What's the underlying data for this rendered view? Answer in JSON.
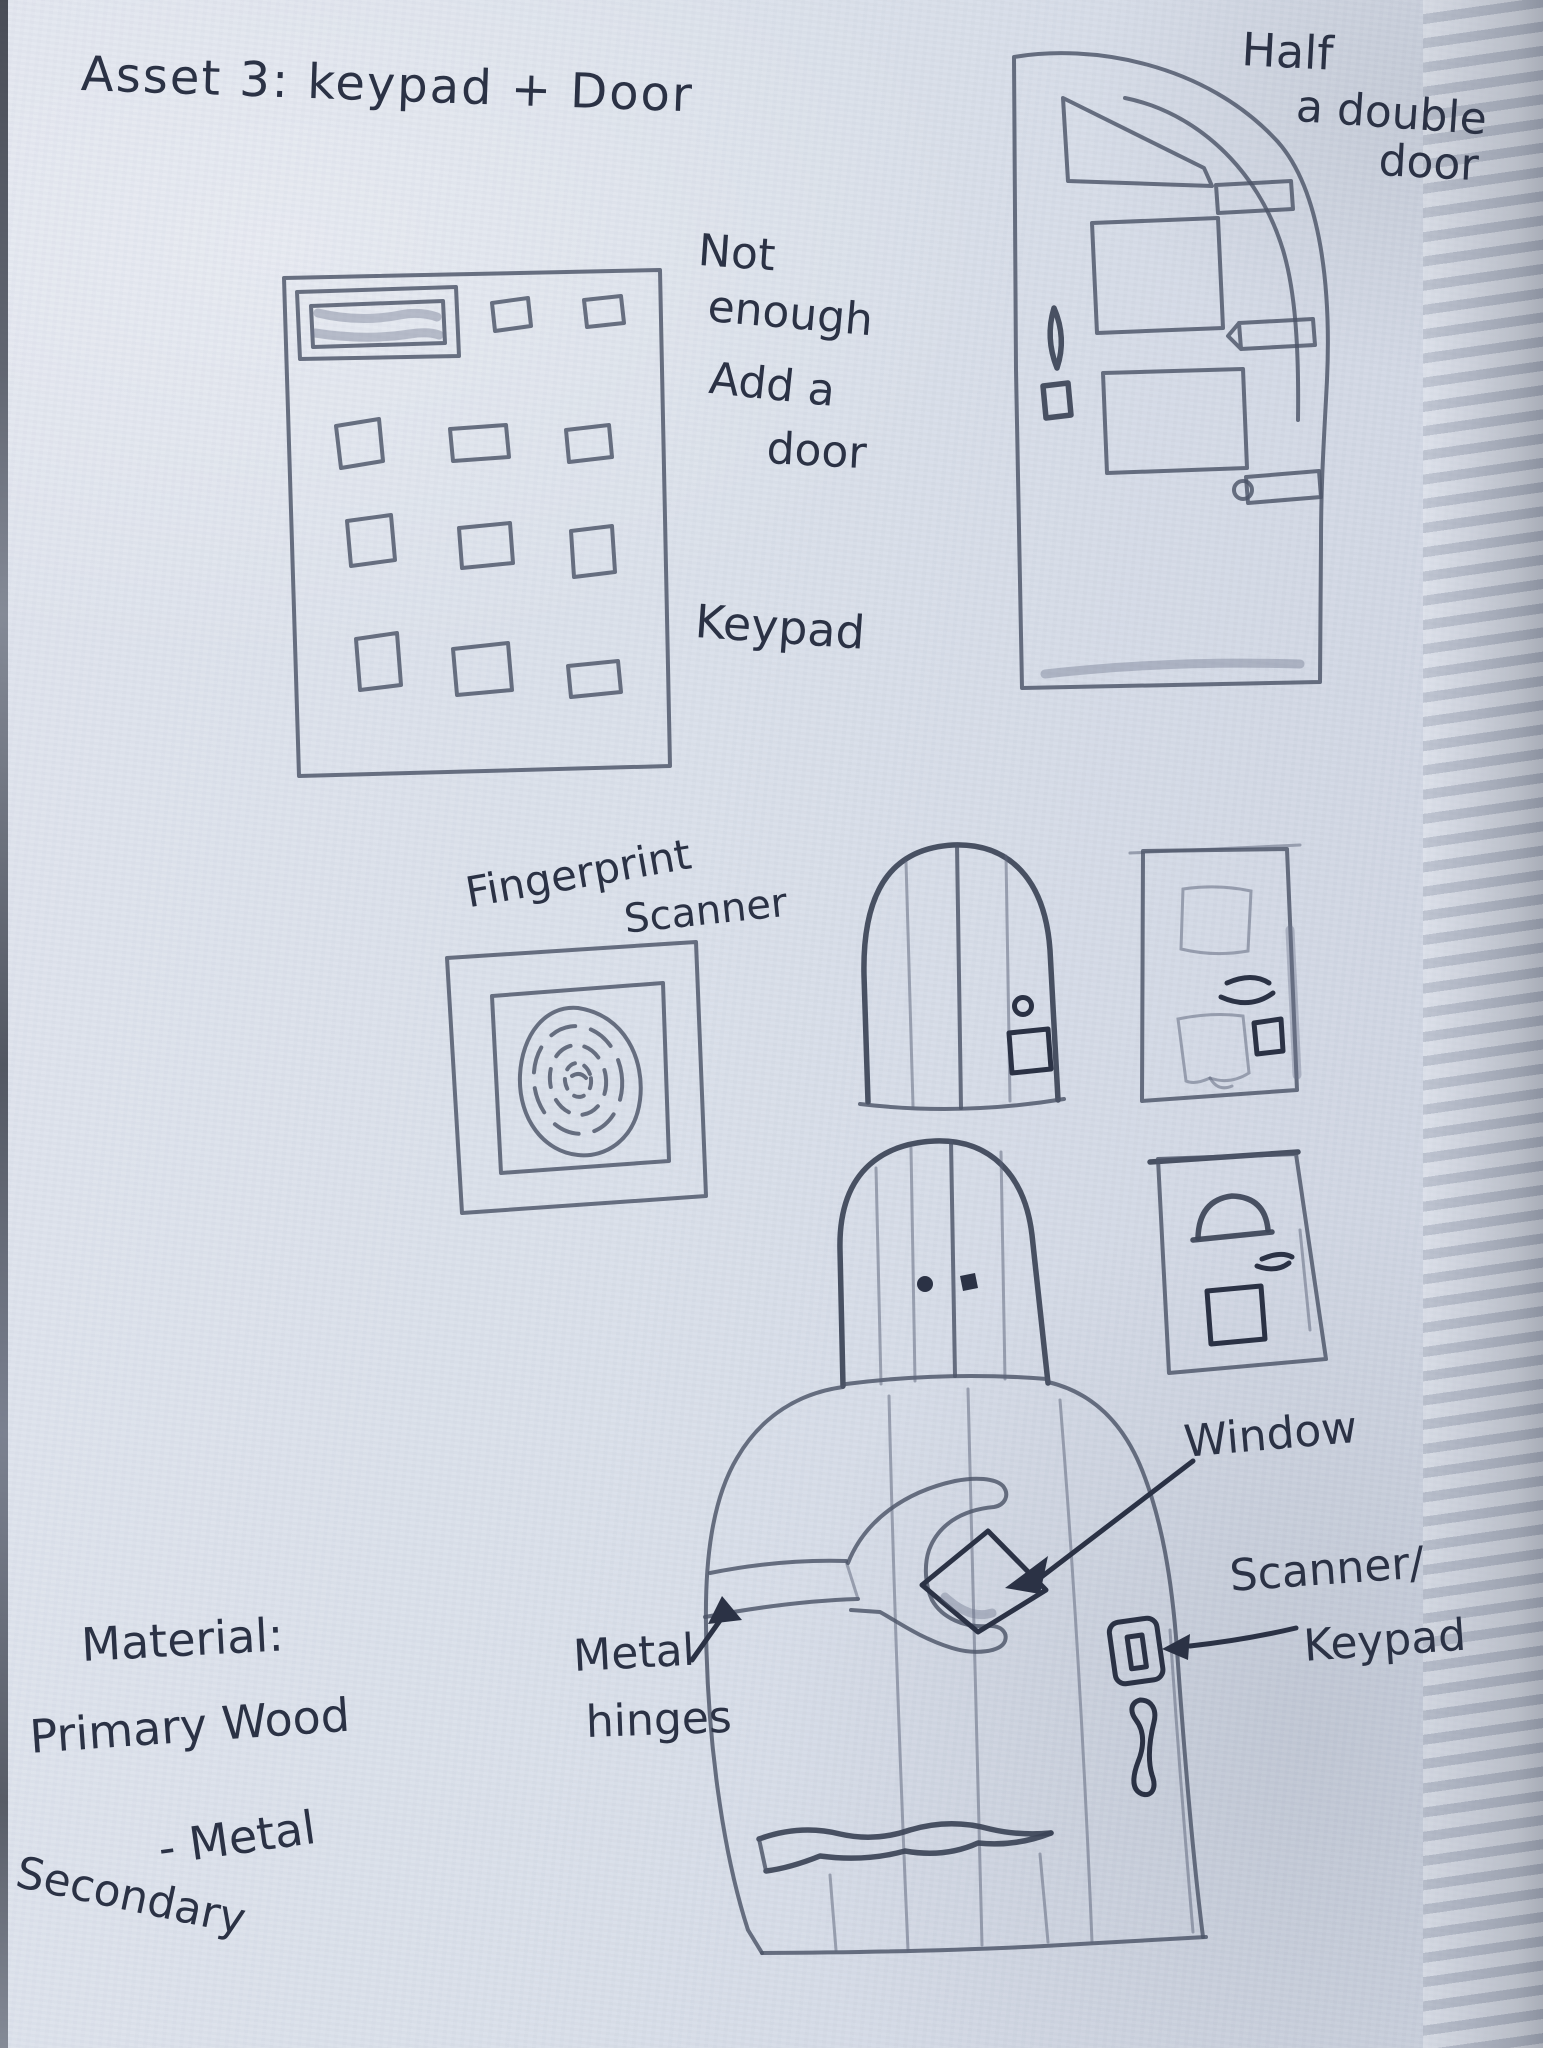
{
  "page": {
    "title": "Asset 3: keypad + Door"
  },
  "labels": {
    "half_door_l1": "Half",
    "half_door_l2": "a double",
    "half_door_l3": "door",
    "note_l1": "Not",
    "note_l2": "enough",
    "note_l3": "Add a",
    "note_l4": "door",
    "keypad": "Keypad",
    "fingerprint_l1": "Fingerprint",
    "fingerprint_l2": "Scanner",
    "window": "Window",
    "scanner_l1": "Scanner/",
    "scanner_l2": "Keypad",
    "hinges_l1": "Metal",
    "hinges_l2": "hinges",
    "material_heading": "Material:",
    "material_primary": "Primary Wood",
    "material_secondary_l1": "Secondary",
    "material_secondary_l2": "- Metal"
  },
  "colors": {
    "paper": "#dce1eb",
    "pencil": "#4c5468",
    "ink": "#2b3245"
  }
}
